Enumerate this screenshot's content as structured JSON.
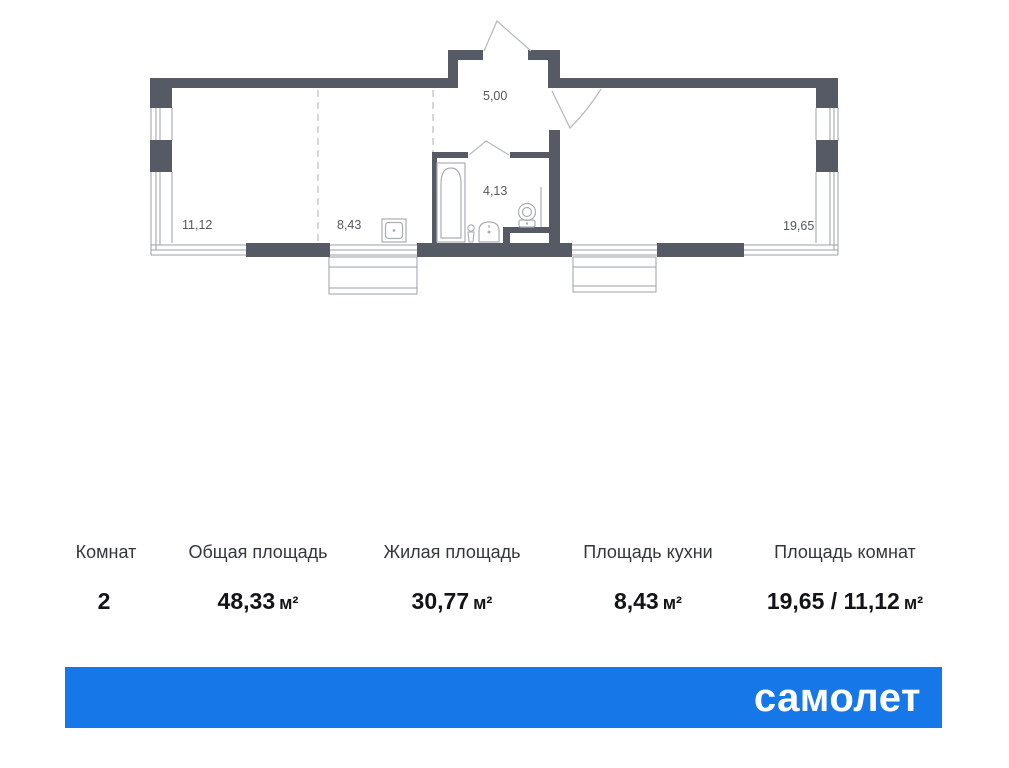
{
  "plan": {
    "room_labels": {
      "living_room": "11,12",
      "kitchen": "8,43",
      "hallway": "5,00",
      "bathroom": "4,13",
      "bedroom": "19,65"
    }
  },
  "summary": {
    "columns": [
      {
        "label": "Комнат",
        "value": "2",
        "unit": ""
      },
      {
        "label": "Общая площадь",
        "value": "48,33",
        "unit": "м²"
      },
      {
        "label": "Жилая площадь",
        "value": "30,77",
        "unit": "м²"
      },
      {
        "label": "Площадь кухни",
        "value": "8,43",
        "unit": "м²"
      },
      {
        "label": "Площадь комнат",
        "value": "19,65 / 11,12",
        "unit": "м²"
      }
    ]
  },
  "footer": {
    "logo_text": "самолет"
  },
  "colors": {
    "wall": "#555a64",
    "thin_line": "#9aa0a8",
    "plan_label": "#53575e",
    "brand": "#1678e8"
  }
}
